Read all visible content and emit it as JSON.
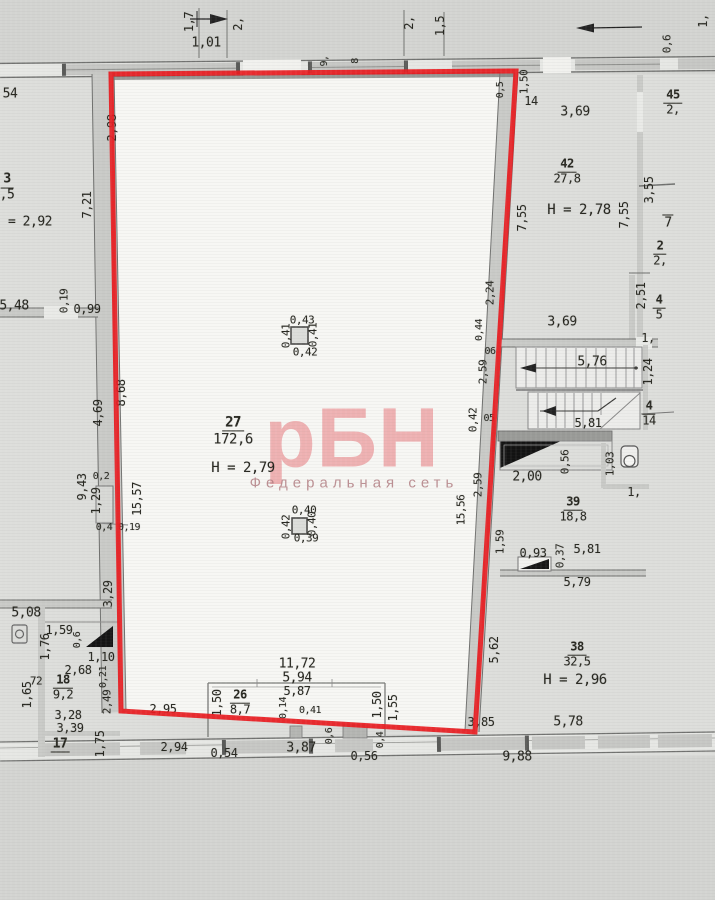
{
  "watermark": {
    "logo": "рБН",
    "subtitle": "Федеральная сеть"
  },
  "colors": {
    "highlight_red": "#e81b1f",
    "paper": "#d3d4d1",
    "room_floor": "#f7f7f4",
    "wall": "#c9cac7",
    "ink": "#26261f",
    "watermark_pink": "#e24951"
  },
  "labels": [
    {
      "t": "1,7",
      "x": 189,
      "y": 22,
      "r": -90
    },
    {
      "t": "1,01",
      "x": 206,
      "y": 43,
      "s": 13
    },
    {
      "t": "2,",
      "x": 238,
      "y": 24,
      "r": -90
    },
    {
      "t": "2,",
      "x": 409,
      "y": 23,
      "r": -90
    },
    {
      "t": "1,5",
      "x": 440,
      "y": 26,
      "r": -90
    },
    {
      "t": "1,",
      "x": 703,
      "y": 21,
      "r": -90
    },
    {
      "t": "0,6",
      "x": 667,
      "y": 44,
      "r": -90,
      "s": 11
    },
    {
      "t": "9,",
      "x": 325,
      "y": 61,
      "r": -90,
      "s": 10
    },
    {
      "t": "8",
      "x": 356,
      "y": 61,
      "r": -90,
      "s": 10
    },
    {
      "t": "54",
      "x": 10,
      "y": 94,
      "s": 13
    },
    {
      "n": "3",
      "d": ",5",
      "x": 7,
      "y": 188,
      "s": 13,
      "name": "room-3-label"
    },
    {
      "t": "= 2,92",
      "x": 30,
      "y": 222,
      "s": 13
    },
    {
      "t": "7,21",
      "x": 87,
      "y": 205,
      "r": -90
    },
    {
      "t": "5,48",
      "x": 14,
      "y": 306,
      "s": 13
    },
    {
      "t": "0,19",
      "x": 64,
      "y": 301,
      "r": -90,
      "s": 11
    },
    {
      "t": "0,99",
      "x": 87,
      "y": 309
    },
    {
      "t": "2,98",
      "x": 112,
      "y": 128,
      "r": -90
    },
    {
      "t": "8,68",
      "x": 121,
      "y": 393,
      "r": -90
    },
    {
      "t": "4,69",
      "x": 98,
      "y": 413,
      "r": -90
    },
    {
      "t": "9,43",
      "x": 82,
      "y": 487,
      "r": -90
    },
    {
      "t": "0,2",
      "x": 101,
      "y": 477,
      "s": 10
    },
    {
      "t": "1,29",
      "x": 96,
      "y": 501,
      "r": -90
    },
    {
      "t": "15,57",
      "x": 137,
      "y": 499,
      "r": -90
    },
    {
      "t": "0,4",
      "x": 104,
      "y": 528,
      "s": 10
    },
    {
      "t": "0,19",
      "x": 129,
      "y": 528,
      "s": 10
    },
    {
      "t": "3,29",
      "x": 108,
      "y": 594,
      "r": -90
    },
    {
      "t": "5,08",
      "x": 26,
      "y": 613,
      "s": 13
    },
    {
      "t": "1,59",
      "x": 59,
      "y": 630
    },
    {
      "t": "0,6",
      "x": 78,
      "y": 640,
      "r": -90,
      "s": 10
    },
    {
      "t": "1,76",
      "x": 45,
      "y": 647,
      "r": -90
    },
    {
      "t": "1,10",
      "x": 101,
      "y": 657
    },
    {
      "t": "2,68",
      "x": 78,
      "y": 670
    },
    {
      "t": "72",
      "x": 36,
      "y": 681,
      "s": 11
    },
    {
      "n": "18",
      "d": "9,2",
      "x": 63,
      "y": 688,
      "name": "room-18-label"
    },
    {
      "t": "1,65",
      "x": 27,
      "y": 695,
      "r": -90
    },
    {
      "t": "0,21",
      "x": 104,
      "y": 677,
      "r": -90,
      "s": 10
    },
    {
      "t": "2,49",
      "x": 107,
      "y": 702,
      "r": -90,
      "s": 11
    },
    {
      "t": "3,28",
      "x": 68,
      "y": 715
    },
    {
      "t": "3,39",
      "x": 70,
      "y": 728
    },
    {
      "t": "17",
      "x": 60,
      "y": 745,
      "ln": "u",
      "s": 13,
      "name": "room-17-label"
    },
    {
      "t": "1,75",
      "x": 100,
      "y": 744,
      "r": -90
    },
    {
      "t": "0,43",
      "x": 302,
      "y": 320,
      "s": 11
    },
    {
      "t": "0,41",
      "x": 286,
      "y": 336,
      "r": -90,
      "s": 11
    },
    {
      "t": "0,41",
      "x": 313,
      "y": 335,
      "r": -90,
      "s": 11
    },
    {
      "t": "0,42",
      "x": 305,
      "y": 352,
      "s": 11
    },
    {
      "n": "27",
      "d": "172,6",
      "x": 233,
      "y": 431,
      "s": 14,
      "name": "room-27-label"
    },
    {
      "t": "H = 2,79",
      "x": 243,
      "y": 468,
      "s": 14,
      "name": "room-27-height"
    },
    {
      "t": "0,40",
      "x": 304,
      "y": 510,
      "s": 11
    },
    {
      "t": "0,42",
      "x": 286,
      "y": 527,
      "r": -90,
      "s": 11
    },
    {
      "t": "0,40",
      "x": 312,
      "y": 524,
      "r": -90,
      "s": 11
    },
    {
      "t": "0,39",
      "x": 306,
      "y": 538,
      "s": 11
    },
    {
      "t": "11,72",
      "x": 297,
      "y": 664,
      "s": 13
    },
    {
      "t": "5,94",
      "x": 297,
      "y": 678,
      "s": 13
    },
    {
      "t": "5,87",
      "x": 297,
      "y": 691
    },
    {
      "n": "26",
      "d": "8,7",
      "x": 240,
      "y": 703,
      "name": "room-26-label"
    },
    {
      "t": "1,50",
      "x": 217,
      "y": 703,
      "r": -90
    },
    {
      "t": "0,14",
      "x": 284,
      "y": 708,
      "r": -90,
      "s": 10
    },
    {
      "t": "0,41",
      "x": 310,
      "y": 711,
      "s": 10
    },
    {
      "t": "1,50",
      "x": 377,
      "y": 705,
      "r": -90
    },
    {
      "t": "1,55",
      "x": 393,
      "y": 708,
      "r": -90
    },
    {
      "t": "2,95",
      "x": 163,
      "y": 709
    },
    {
      "t": "3,85",
      "x": 481,
      "y": 722
    },
    {
      "t": "2,94",
      "x": 174,
      "y": 747
    },
    {
      "t": "0,54",
      "x": 224,
      "y": 753
    },
    {
      "t": "3,87",
      "x": 301,
      "y": 748,
      "s": 13
    },
    {
      "t": "0,6",
      "x": 330,
      "y": 736,
      "r": -90,
      "s": 10
    },
    {
      "t": "0,4",
      "x": 381,
      "y": 740,
      "r": -90,
      "s": 10
    },
    {
      "t": "0,56",
      "x": 364,
      "y": 756
    },
    {
      "t": "9,88",
      "x": 517,
      "y": 757,
      "s": 13
    },
    {
      "t": "1,50",
      "x": 524,
      "y": 82,
      "r": -90,
      "s": 11
    },
    {
      "t": "0,5",
      "x": 501,
      "y": 90,
      "r": -90,
      "s": 10
    },
    {
      "t": "14",
      "x": 531,
      "y": 101
    },
    {
      "t": "3,69",
      "x": 575,
      "y": 112,
      "s": 13
    },
    {
      "n": "45",
      "d": "2,",
      "x": 673,
      "y": 103,
      "name": "room-45-label"
    },
    {
      "n": "42",
      "d": "27,8",
      "x": 567,
      "y": 172,
      "name": "room-42-label"
    },
    {
      "t": "H = 2,78",
      "x": 579,
      "y": 210,
      "s": 14,
      "name": "room-42-height"
    },
    {
      "t": "7,55",
      "x": 522,
      "y": 218,
      "r": -90
    },
    {
      "t": "7,55",
      "x": 624,
      "y": 215,
      "r": -90
    },
    {
      "t": "3,55",
      "x": 649,
      "y": 190,
      "r": -90
    },
    {
      "t": "7",
      "x": 668,
      "y": 222,
      "ln": "o",
      "s": 13
    },
    {
      "n": "2",
      "d": "2,",
      "x": 660,
      "y": 254
    },
    {
      "t": "2,51",
      "x": 641,
      "y": 296,
      "r": -90
    },
    {
      "n": "4",
      "d": "5",
      "x": 659,
      "y": 308
    },
    {
      "t": "3,69",
      "x": 562,
      "y": 322,
      "s": 13
    },
    {
      "t": "2,24",
      "x": 490,
      "y": 293,
      "r": -90,
      "s": 11
    },
    {
      "t": "0,44",
      "x": 480,
      "y": 330,
      "r": -90,
      "s": 10
    },
    {
      "t": "06",
      "x": 490,
      "y": 352,
      "s": 10
    },
    {
      "t": "1,",
      "x": 648,
      "y": 338
    },
    {
      "t": "5,76",
      "x": 592,
      "y": 362,
      "s": 13
    },
    {
      "t": "1,24",
      "x": 648,
      "y": 372,
      "r": -90
    },
    {
      "t": "2,59",
      "x": 483,
      "y": 372,
      "r": -90,
      "s": 11
    },
    {
      "t": "0,42",
      "x": 473,
      "y": 420,
      "r": -90,
      "s": 11
    },
    {
      "t": "05",
      "x": 489,
      "y": 419,
      "s": 10
    },
    {
      "t": "5,81",
      "x": 588,
      "y": 423
    },
    {
      "n": "4",
      "d": "14",
      "x": 649,
      "y": 414
    },
    {
      "t": "2,00",
      "x": 527,
      "y": 477,
      "s": 13
    },
    {
      "t": "0,56",
      "x": 565,
      "y": 462,
      "r": -90,
      "s": 11
    },
    {
      "t": "1,03",
      "x": 610,
      "y": 464,
      "r": -90,
      "s": 11
    },
    {
      "t": "1,",
      "x": 634,
      "y": 492
    },
    {
      "n": "39",
      "d": "18,8",
      "x": 573,
      "y": 510,
      "name": "room-39-label"
    },
    {
      "t": "2,59",
      "x": 478,
      "y": 485,
      "r": -90,
      "s": 11
    },
    {
      "t": "15,56",
      "x": 461,
      "y": 510,
      "r": -90,
      "s": 11
    },
    {
      "t": "1,59",
      "x": 500,
      "y": 542,
      "r": -90,
      "s": 11
    },
    {
      "t": "0,93",
      "x": 533,
      "y": 553
    },
    {
      "t": "0,37",
      "x": 560,
      "y": 556,
      "r": -90,
      "s": 11
    },
    {
      "t": "5,81",
      "x": 587,
      "y": 549
    },
    {
      "t": "5,79",
      "x": 577,
      "y": 582
    },
    {
      "n": "38",
      "d": "32,5",
      "x": 577,
      "y": 655,
      "name": "room-38-label"
    },
    {
      "t": "H = 2,96",
      "x": 575,
      "y": 680,
      "s": 14,
      "name": "room-38-height"
    },
    {
      "t": "5,62",
      "x": 494,
      "y": 650,
      "r": -90
    },
    {
      "t": "5,78",
      "x": 568,
      "y": 722,
      "s": 13
    }
  ]
}
